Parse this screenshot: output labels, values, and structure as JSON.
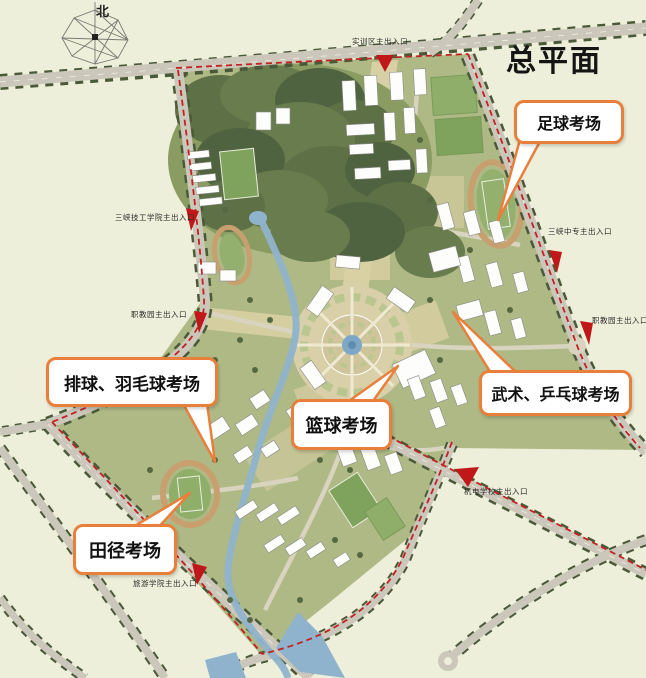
{
  "title": "总平面",
  "north_label": "北",
  "entrances": {
    "shixunqu": "实训区主出入口",
    "sanxia_jigong": "三峡技工学院主出入口",
    "zhijiaoyuan_left": "职教园主出入口",
    "sanxia_zhongzhuan": "三峡中专主出入口",
    "zhijiaoyuan_right": "职教园主出入口",
    "jidian": "机电学校主出入口",
    "lvyou": "旅游学院主出入口"
  },
  "callouts": {
    "football": "足球考场",
    "volleyball_badminton": "排球、羽毛球考场",
    "basketball": "篮球考场",
    "wushu_pingpong": "武术、乒乓球考场",
    "track_field": "田径考场"
  },
  "colors": {
    "background": "#edefda",
    "callout_border": "#e8803c",
    "boundary_red": "#c32222",
    "site_green": "#aeb985",
    "forest_green": "#5d7046",
    "water_blue": "#8fb3cc",
    "road_gray": "#cbc7ba",
    "track_ring": "#c8a070"
  }
}
